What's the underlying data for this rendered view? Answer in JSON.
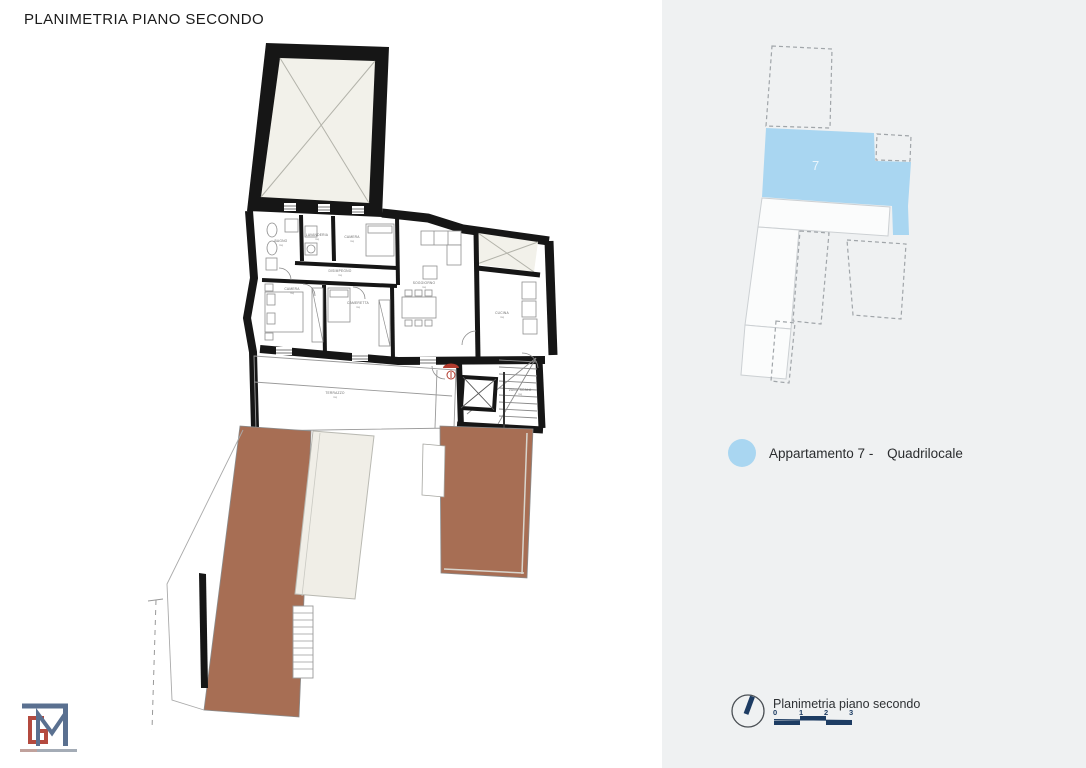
{
  "title": "PLANIMETRIA PIANO SECONDO",
  "right_panel": {
    "keyplan_unit_number": "7",
    "legend": {
      "swatch": "apartment-7-blue",
      "label_part1": "Appartamento 7 -",
      "label_part2": "Quadrilocale"
    },
    "footer": {
      "north_icon": "compass-north-arrow",
      "caption": "Planimetria piano secondo",
      "scale_ticks": [
        "0",
        "1",
        "2",
        "3"
      ]
    }
  },
  "floorplan": {
    "area_unit": "mq",
    "rooms": {
      "bagno": "BAGNO",
      "lavanderia": "LAVANDERIA",
      "camera_piccola": "CAMERA",
      "soggiorno": "SOGGIORNO",
      "cucina": "CUCINA",
      "camera": "CAMERA",
      "cameretta": "CAMERETTA",
      "disimpegno": "DISIMPEGNO",
      "vano_scala": "VANO SCALA",
      "terrazzo": "TERRAZZO"
    }
  },
  "logo": {
    "monogram": "GM"
  },
  "colors": {
    "panel_bg": "#eff1f2",
    "apartment_blue": "#a9d6f1",
    "roof_brown": "#a76e54",
    "xroom_beige": "#f2f1ea",
    "wall_black": "#161616",
    "scale_navy": "#1d3c63",
    "logo_slate": "#5a7090",
    "logo_red": "#b44a3f",
    "keyplan_number_white": "#eaf5fc"
  }
}
